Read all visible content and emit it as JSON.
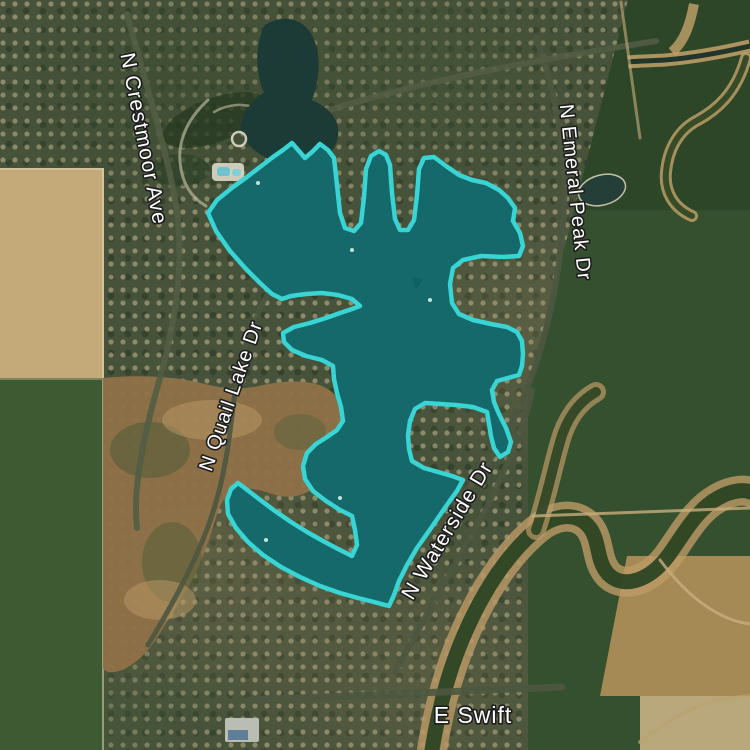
{
  "map": {
    "view": "satellite",
    "street_labels": [
      {
        "id": "n-crestmoor-ave",
        "text": "N Crestmoor Ave"
      },
      {
        "id": "n-emeral-peak-dr",
        "text": "N Emeral Peak Dr"
      },
      {
        "id": "n-quail-lake-dr",
        "text": "N Quail Lake Dr"
      },
      {
        "id": "n-waterside-dr",
        "text": "N Waterside Dr"
      },
      {
        "id": "e-swift",
        "text": "E Swift"
      }
    ],
    "label_style": {
      "fill": "#ffffff",
      "outline": "#1e1e1e"
    },
    "highlighted_region": {
      "kind": "lake-boundary-highlight",
      "fill": "#15696b",
      "stroke": "#38d5d4",
      "stroke_width": 4.5
    }
  }
}
